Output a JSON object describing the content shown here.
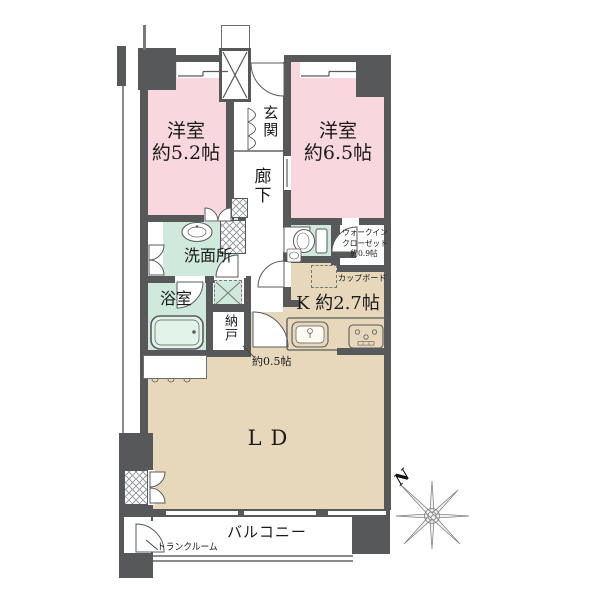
{
  "plan_title": "apartment floor plan",
  "rooms": {
    "bedroom1": {
      "name": "洋室",
      "size": "約5.2帖"
    },
    "bedroom2": {
      "name": "洋室",
      "size": "約6.5帖"
    },
    "entrance": {
      "name": "玄関"
    },
    "hallway": {
      "name": "廊下"
    },
    "washroom": {
      "name": "洗面所"
    },
    "bathroom": {
      "name": "浴室"
    },
    "storage_room": {
      "name": "納戸",
      "size": "約0.5帖"
    },
    "walk_in_closet": {
      "line1": "ウォークイン",
      "line2": "クローゼット",
      "line3": "約0.9帖"
    },
    "kitchen": {
      "name": "K 約2.7帖"
    },
    "living_dining": {
      "name": "LD"
    },
    "balcony": {
      "name": "バルコニー"
    },
    "trunk_room": {
      "name": "トランクルーム"
    },
    "cupboard": {
      "name": "カップボード"
    }
  },
  "compass": {
    "north_label": "N"
  },
  "colors": {
    "wall": "#57585a",
    "bedroom_pink": "#f8d8de",
    "wet_area_mint": "#cfe9dc",
    "floor_beige": "#e7d8bc"
  }
}
